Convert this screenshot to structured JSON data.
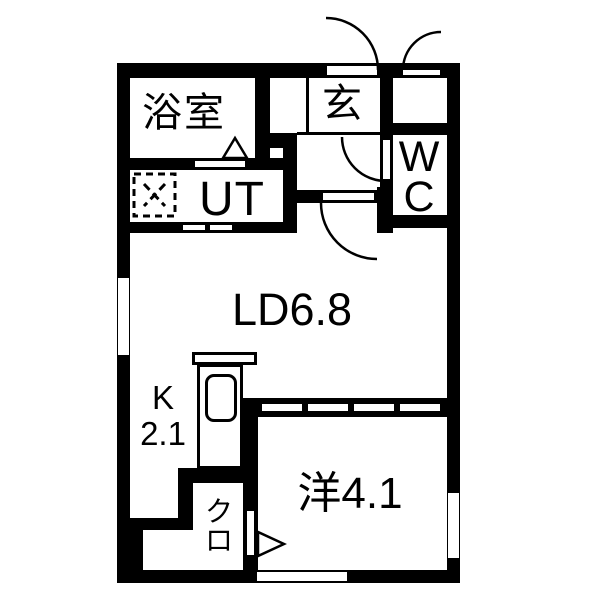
{
  "floorplan": {
    "colors": {
      "wall": "#000000",
      "background": "#ffffff",
      "text": "#000000"
    },
    "rooms": {
      "bathroom": {
        "label": "浴室"
      },
      "utility": {
        "label": "UT"
      },
      "entrance": {
        "label": "玄"
      },
      "toilet": {
        "label": "WC"
      },
      "living_dining": {
        "name": "LD",
        "area": "6.8"
      },
      "kitchen": {
        "name": "K",
        "area": "2.1"
      },
      "western_room": {
        "name": "洋",
        "area": "4.1"
      },
      "closet": {
        "label": "クロ"
      }
    }
  }
}
